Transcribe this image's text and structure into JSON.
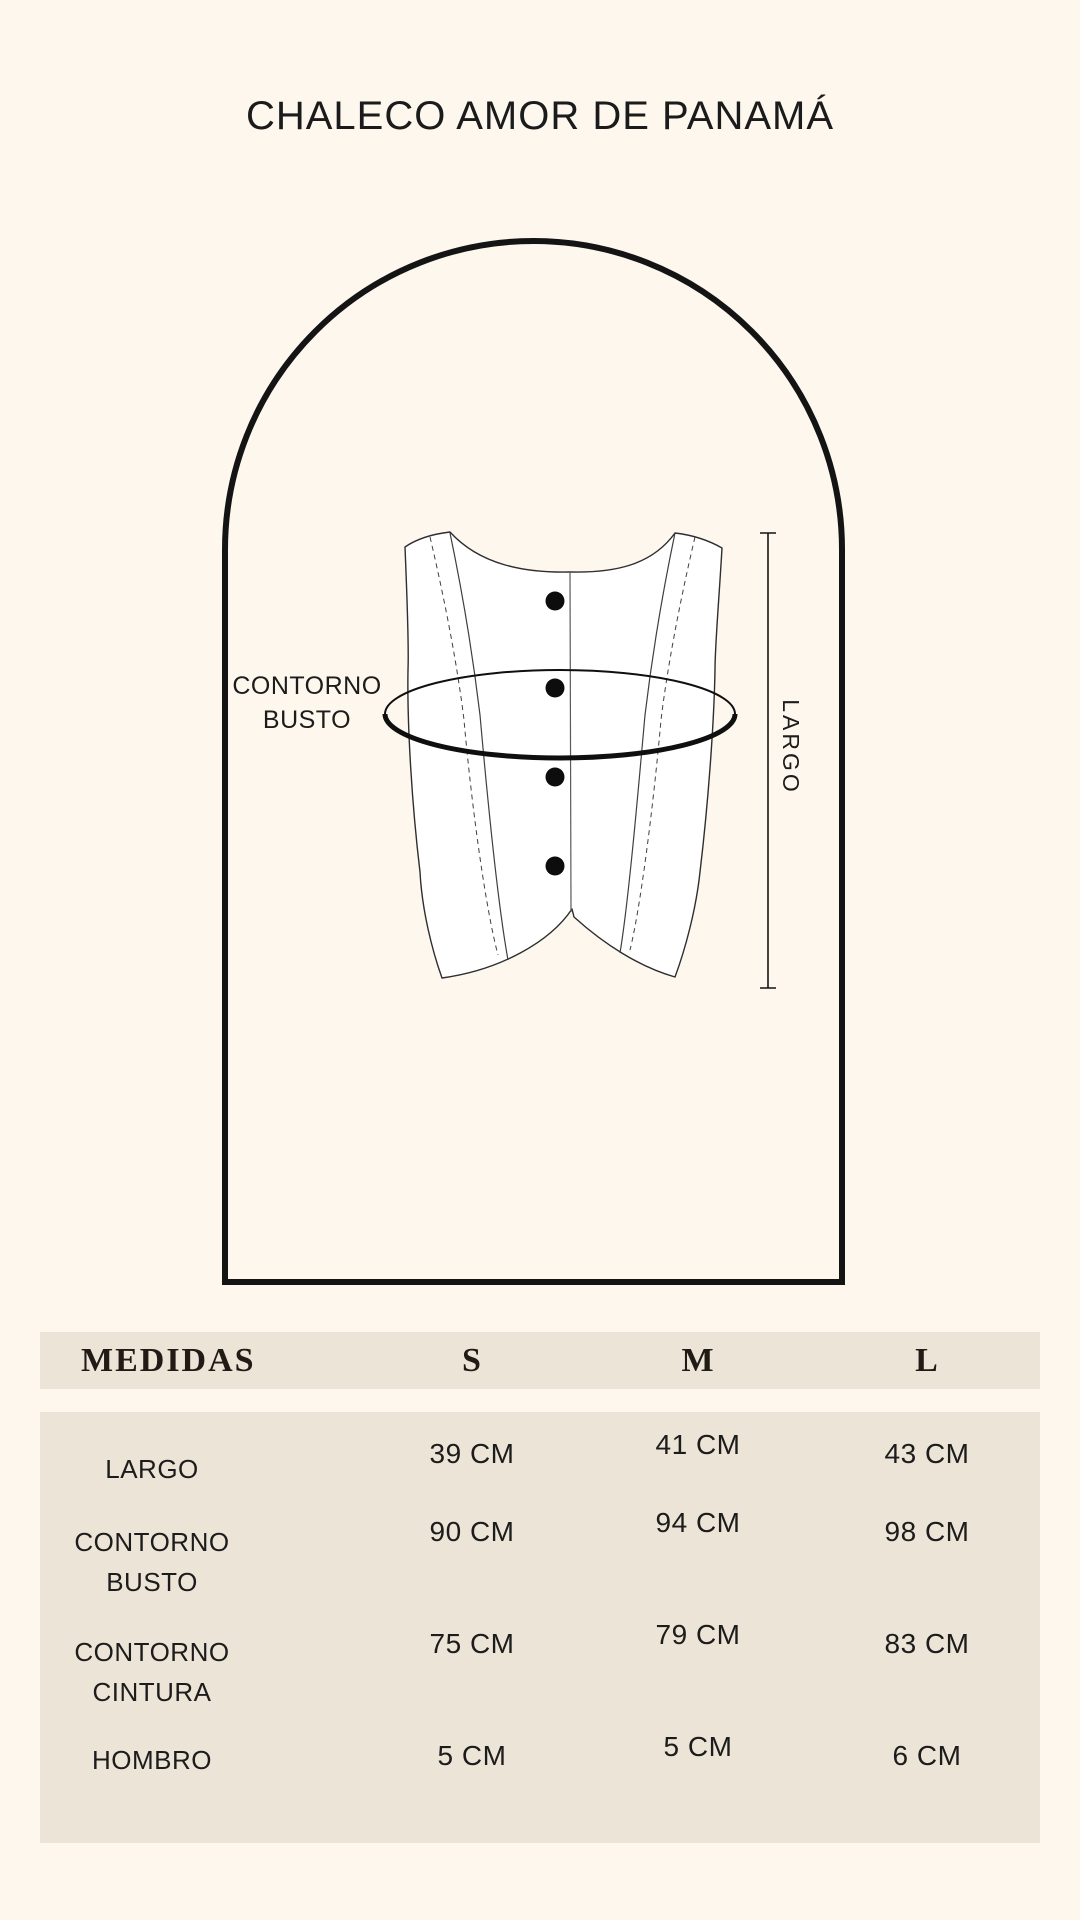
{
  "page": {
    "title": "CHALECO AMOR DE PANAMÁ"
  },
  "diagram": {
    "bust_label_line1": "CONTORNO",
    "bust_label_line2": "BUSTO",
    "length_label": "LARGO"
  },
  "table": {
    "header": {
      "measure_col": "MEDIDAS",
      "sizes": [
        "S",
        "M",
        "L"
      ]
    },
    "rows": [
      {
        "label_lines": [
          "LARGO"
        ],
        "values": [
          "39 CM",
          "41 CM",
          "43 CM"
        ]
      },
      {
        "label_lines": [
          "CONTORNO",
          "BUSTO"
        ],
        "values": [
          "90 CM",
          "94 CM",
          "98 CM"
        ]
      },
      {
        "label_lines": [
          "CONTORNO",
          "CINTURA"
        ],
        "values": [
          "75 CM",
          "79 CM",
          "83 CM"
        ]
      },
      {
        "label_lines": [
          "HOMBRO"
        ],
        "values": [
          "5 CM",
          "5 CM",
          "6 CM"
        ]
      }
    ]
  },
  "colors": {
    "background": "#fdf7ee",
    "table_background": "#ece4d6",
    "line_black": "#141414",
    "text": "#1b1b1b"
  }
}
